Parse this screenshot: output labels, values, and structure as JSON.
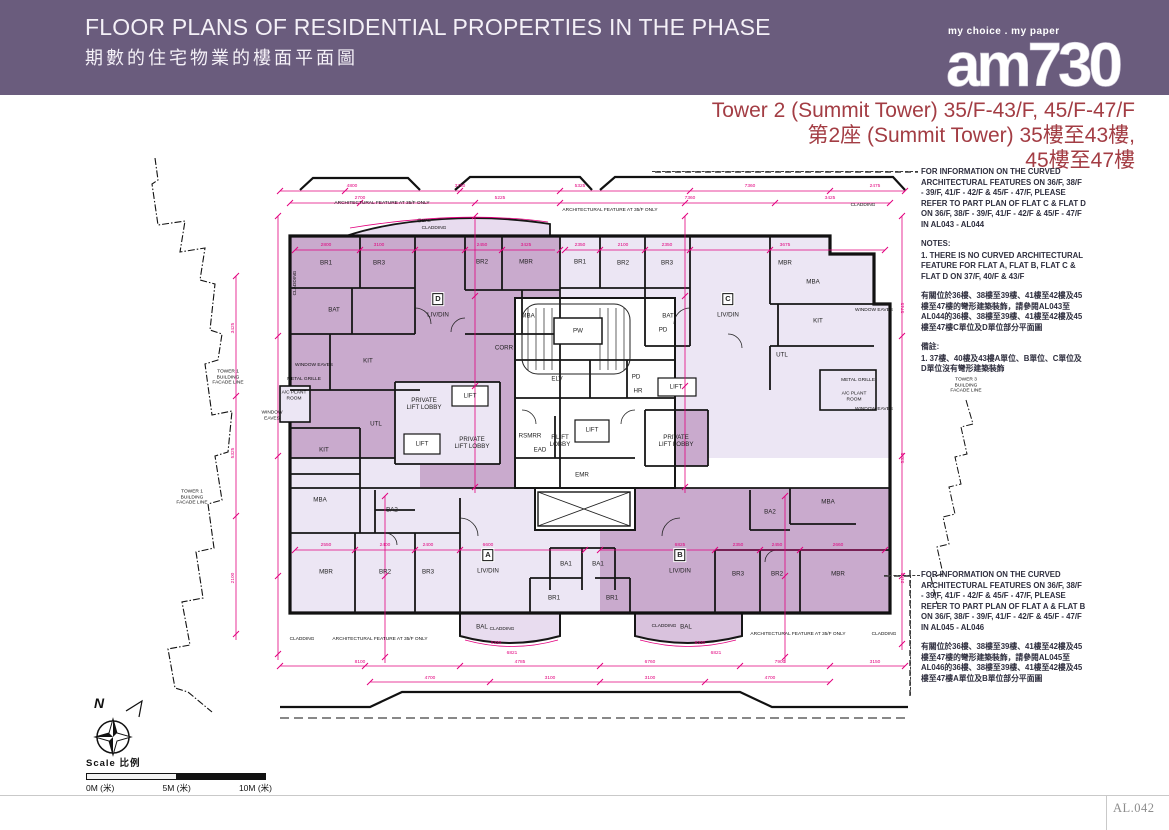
{
  "header": {
    "title_en": "FLOOR PLANS OF RESIDENTIAL PROPERTIES IN THE PHASE",
    "title_zh": "期數的住宅物業的樓面平面圖",
    "logo_tagline": "my choice . my paper",
    "logo_text": "am730"
  },
  "tower_title": {
    "line1": "Tower 2 (Summit Tower) 35/F-43/F, 45/F-47/F",
    "line2": "第2座 (Summit Tower) 35樓至43樓,",
    "line3": "45樓至47樓"
  },
  "notes_top": {
    "en": "FOR INFORMATION ON THE CURVED\nARCHITECTURAL FEATURES ON 36/F, 38/F\n- 39/F, 41/F - 42/F & 45/F - 47/F, PLEASE\nREFER TO PART PLAN OF FLAT C & FLAT D\nON 36/F, 38/F - 39/F, 41/F - 42/F & 45/F - 47/F\nIN AL043 - AL044",
    "notes_heading": "NOTES:",
    "note1": "1.  THERE IS NO CURVED ARCHITECTURAL\nFEATURE FOR FLAT A, FLAT B, FLAT C &\nFLAT D ON 37/F, 40/F & 43/F",
    "zh": "有關位於36樓、38樓至39樓、41樓至42樓及45\n樓至47樓的彎形建築裝飾，請參閱AL043至\nAL044的36樓、38樓至39樓、41樓至42樓及45\n樓至47樓C單位及D單位部分平面圖",
    "zh_heading": "備註:",
    "zh_note1": "1.  37樓、40樓及43樓A單位、B單位、C單位及\nD單位沒有彎形建築裝飾"
  },
  "notes_bottom": {
    "en": "FOR INFORMATION ON THE CURVED\nARCHITECTURAL FEATURES ON 36/F, 38/F\n- 39/F, 41/F - 42/F & 45/F - 47/F, PLEASE\nREFER TO PART PLAN OF FLAT A & FLAT B\nON 36/F, 38/F - 39/F, 41/F - 42/F & 45/F - 47/F\nIN AL045 - AL046",
    "zh": "有關位於36樓、38樓至39樓、41樓至42樓及45\n樓至47樓的彎形建築裝飾，請參閱AL045至\nAL046的36樓、38樓至39樓、41樓至42樓及45\n樓至47樓A單位及B單位部分平面圖"
  },
  "scale": {
    "label": "Scale  比例",
    "m0": "0M (米)",
    "m5": "5M (米)",
    "m10": "10M (米)"
  },
  "compass": {
    "north": "N"
  },
  "page_number": "AL.042",
  "colors": {
    "band_purple": "#6a5c7d",
    "title_red": "#a33d44",
    "dimension_magenta": "#e2007e",
    "unit_mauve": "#c9aacd",
    "unit_light": "#ece6f4"
  },
  "plan": {
    "labels": [
      {
        "t": "BR1",
        "x": 196,
        "y": 105
      },
      {
        "t": "BR3",
        "x": 249,
        "y": 105
      },
      {
        "t": "BR2",
        "x": 352,
        "y": 104
      },
      {
        "t": "MBR",
        "x": 396,
        "y": 104
      },
      {
        "t": "BAT",
        "x": 204,
        "y": 152
      },
      {
        "t": "MBA",
        "x": 398,
        "y": 158
      },
      {
        "t": "D",
        "x": 308,
        "y": 141,
        "c": "un"
      },
      {
        "t": "LIV/DIN",
        "x": 308,
        "y": 157
      },
      {
        "t": "KIT",
        "x": 238,
        "y": 203
      },
      {
        "t": "CORR",
        "x": 374,
        "y": 190
      },
      {
        "t": "PRIVATE\nLIFT LOBBY",
        "x": 294,
        "y": 246
      },
      {
        "t": "LIFT",
        "x": 340,
        "y": 238
      },
      {
        "t": "UTL",
        "x": 246,
        "y": 266
      },
      {
        "t": "LIFT",
        "x": 292,
        "y": 286
      },
      {
        "t": "PRIVATE\nLIFT LOBBY",
        "x": 342,
        "y": 285
      },
      {
        "t": "BR1",
        "x": 450,
        "y": 104
      },
      {
        "t": "BR2",
        "x": 493,
        "y": 105
      },
      {
        "t": "BR3",
        "x": 537,
        "y": 105
      },
      {
        "t": "MBR",
        "x": 655,
        "y": 105
      },
      {
        "t": "MBA",
        "x": 683,
        "y": 124
      },
      {
        "t": "BAT",
        "x": 538,
        "y": 158
      },
      {
        "t": "C",
        "x": 598,
        "y": 141,
        "c": "un"
      },
      {
        "t": "LIV/DIN",
        "x": 598,
        "y": 157
      },
      {
        "t": "KIT",
        "x": 688,
        "y": 163
      },
      {
        "t": "UTL",
        "x": 652,
        "y": 197
      },
      {
        "t": "LIFT",
        "x": 546,
        "y": 229
      },
      {
        "t": "PRIVATE\nLIFT LOBBY",
        "x": 546,
        "y": 283
      },
      {
        "t": "PW",
        "x": 448,
        "y": 173
      },
      {
        "t": "ELV",
        "x": 427,
        "y": 221
      },
      {
        "t": "PD",
        "x": 506,
        "y": 219
      },
      {
        "t": "HR",
        "x": 508,
        "y": 233
      },
      {
        "t": "PD",
        "x": 533,
        "y": 172
      },
      {
        "t": "F.LIFT\nLOBBY",
        "x": 430,
        "y": 283
      },
      {
        "t": "LIFT",
        "x": 462,
        "y": 272
      },
      {
        "t": "RSMRR",
        "x": 400,
        "y": 278
      },
      {
        "t": "EAD",
        "x": 410,
        "y": 292
      },
      {
        "t": "EMR",
        "x": 452,
        "y": 317
      },
      {
        "t": "KIT",
        "x": 194,
        "y": 292
      },
      {
        "t": "MBA",
        "x": 190,
        "y": 342
      },
      {
        "t": "BA2",
        "x": 262,
        "y": 352
      },
      {
        "t": "MBR",
        "x": 196,
        "y": 414
      },
      {
        "t": "BR2",
        "x": 255,
        "y": 414
      },
      {
        "t": "BR3",
        "x": 298,
        "y": 414
      },
      {
        "t": "A",
        "x": 358,
        "y": 397,
        "c": "un"
      },
      {
        "t": "LIV/DIN",
        "x": 358,
        "y": 413
      },
      {
        "t": "BA1",
        "x": 436,
        "y": 406
      },
      {
        "t": "BA1",
        "x": 468,
        "y": 406
      },
      {
        "t": "BR1",
        "x": 424,
        "y": 440
      },
      {
        "t": "BAL",
        "x": 352,
        "y": 469
      },
      {
        "t": "B",
        "x": 550,
        "y": 397,
        "c": "un"
      },
      {
        "t": "LIV/DIN",
        "x": 550,
        "y": 413
      },
      {
        "t": "BR1",
        "x": 482,
        "y": 440
      },
      {
        "t": "BR3",
        "x": 608,
        "y": 416
      },
      {
        "t": "BR2",
        "x": 647,
        "y": 416
      },
      {
        "t": "MBR",
        "x": 708,
        "y": 416
      },
      {
        "t": "MBA",
        "x": 698,
        "y": 344
      },
      {
        "t": "BA2",
        "x": 640,
        "y": 354
      },
      {
        "t": "BAL",
        "x": 556,
        "y": 469
      },
      {
        "t": "ARCHITECTURAL FEATURE AT 35/F ONLY",
        "x": 252,
        "y": 46,
        "c": "an"
      },
      {
        "t": "ARCHITECTURAL FEATURE AT 35/F ONLY",
        "x": 480,
        "y": 53,
        "c": "an"
      },
      {
        "t": "@BAL",
        "x": 294,
        "y": 64,
        "c": "an"
      },
      {
        "t": "CLADDING",
        "x": 304,
        "y": 71,
        "c": "an"
      },
      {
        "t": "CLADDING",
        "x": 733,
        "y": 48,
        "c": "an"
      },
      {
        "t": "CLADDING",
        "x": 166,
        "y": 125,
        "c": "an",
        "r": -90
      },
      {
        "t": "WINDOW EAVES",
        "x": 184,
        "y": 208,
        "c": "an"
      },
      {
        "t": "METAL GRILLE",
        "x": 174,
        "y": 222,
        "c": "an"
      },
      {
        "t": "A/C PLANT\nROOM",
        "x": 164,
        "y": 238,
        "c": "an"
      },
      {
        "t": "WINDOW\nEAVES",
        "x": 142,
        "y": 258,
        "c": "an"
      },
      {
        "t": "WINDOW EAVES",
        "x": 744,
        "y": 153,
        "c": "an"
      },
      {
        "t": "METAL GRILLE",
        "x": 728,
        "y": 223,
        "c": "an"
      },
      {
        "t": "A/C PLANT\nROOM",
        "x": 724,
        "y": 239,
        "c": "an"
      },
      {
        "t": "WINDOW EAVES",
        "x": 744,
        "y": 252,
        "c": "an"
      },
      {
        "t": "TOWER 1\nBUILDING\nFACADE LINE",
        "x": 98,
        "y": 220,
        "c": "an"
      },
      {
        "t": "TOWER 1\nBUILDING\nFACADE LINE",
        "x": 62,
        "y": 340,
        "c": "an"
      },
      {
        "t": "TOWER 3\nBUILDING\nFACADE LINE",
        "x": 836,
        "y": 228,
        "c": "an"
      },
      {
        "t": "CLADDING",
        "x": 172,
        "y": 482,
        "c": "an"
      },
      {
        "t": "ARCHITECTURAL FEATURE AT 35/F ONLY",
        "x": 250,
        "y": 482,
        "c": "an"
      },
      {
        "t": "CLADDING",
        "x": 372,
        "y": 472,
        "c": "an"
      },
      {
        "t": "CLADDING",
        "x": 534,
        "y": 469,
        "c": "an"
      },
      {
        "t": "ARCHITECTURAL FEATURE AT 35/F ONLY",
        "x": 668,
        "y": 477,
        "c": "an"
      },
      {
        "t": "CLADDING",
        "x": 754,
        "y": 477,
        "c": "an"
      },
      {
        "t": "4800",
        "x": 222,
        "y": 29,
        "c": "dim"
      },
      {
        "t": "3750",
        "x": 330,
        "y": 29,
        "c": "dim"
      },
      {
        "t": "5325",
        "x": 450,
        "y": 29,
        "c": "dim"
      },
      {
        "t": "7360",
        "x": 620,
        "y": 29,
        "c": "dim"
      },
      {
        "t": "2475",
        "x": 745,
        "y": 29,
        "c": "dim"
      },
      {
        "t": "2700",
        "x": 230,
        "y": 41,
        "c": "dim"
      },
      {
        "t": "5225",
        "x": 370,
        "y": 41,
        "c": "dim"
      },
      {
        "t": "7360",
        "x": 560,
        "y": 41,
        "c": "dim"
      },
      {
        "t": "3425",
        "x": 700,
        "y": 41,
        "c": "dim"
      },
      {
        "t": "2800",
        "x": 196,
        "y": 88,
        "c": "dim"
      },
      {
        "t": "3100",
        "x": 249,
        "y": 88,
        "c": "dim"
      },
      {
        "t": "2450",
        "x": 352,
        "y": 88,
        "c": "dim"
      },
      {
        "t": "3425",
        "x": 396,
        "y": 88,
        "c": "dim"
      },
      {
        "t": "2350",
        "x": 450,
        "y": 88,
        "c": "dim"
      },
      {
        "t": "2100",
        "x": 493,
        "y": 88,
        "c": "dim"
      },
      {
        "t": "2350",
        "x": 537,
        "y": 88,
        "c": "dim"
      },
      {
        "t": "3675",
        "x": 655,
        "y": 88,
        "c": "dim"
      },
      {
        "t": "2550",
        "x": 196,
        "y": 388,
        "c": "dim"
      },
      {
        "t": "2400",
        "x": 255,
        "y": 388,
        "c": "dim"
      },
      {
        "t": "2400",
        "x": 298,
        "y": 388,
        "c": "dim"
      },
      {
        "t": "6600",
        "x": 358,
        "y": 388,
        "c": "dim"
      },
      {
        "t": "6825",
        "x": 550,
        "y": 388,
        "c": "dim"
      },
      {
        "t": "2350",
        "x": 608,
        "y": 388,
        "c": "dim"
      },
      {
        "t": "2450",
        "x": 647,
        "y": 388,
        "c": "dim"
      },
      {
        "t": "2660",
        "x": 708,
        "y": 388,
        "c": "dim"
      },
      {
        "t": "8100",
        "x": 230,
        "y": 505,
        "c": "dim"
      },
      {
        "t": "4785",
        "x": 390,
        "y": 505,
        "c": "dim"
      },
      {
        "t": "6760",
        "x": 520,
        "y": 505,
        "c": "dim"
      },
      {
        "t": "7900",
        "x": 650,
        "y": 505,
        "c": "dim"
      },
      {
        "t": "3150",
        "x": 745,
        "y": 505,
        "c": "dim"
      },
      {
        "t": "4700",
        "x": 300,
        "y": 521,
        "c": "dim"
      },
      {
        "t": "3100",
        "x": 420,
        "y": 521,
        "c": "dim"
      },
      {
        "t": "3100",
        "x": 520,
        "y": 521,
        "c": "dim"
      },
      {
        "t": "4700",
        "x": 640,
        "y": 521,
        "c": "dim"
      },
      {
        "t": "3425",
        "x": 104,
        "y": 170,
        "c": "dim",
        "r": -90
      },
      {
        "t": "5325",
        "x": 104,
        "y": 295,
        "c": "dim",
        "r": -90
      },
      {
        "t": "2100",
        "x": 104,
        "y": 420,
        "c": "dim",
        "r": -90
      },
      {
        "t": "5745",
        "x": 774,
        "y": 150,
        "c": "dim",
        "r": -90
      },
      {
        "t": "5325",
        "x": 774,
        "y": 300,
        "c": "dim",
        "r": -90
      },
      {
        "t": "2105",
        "x": 774,
        "y": 420,
        "c": "dim",
        "r": -90
      },
      {
        "t": "6320",
        "x": 366,
        "y": 486,
        "c": "dim"
      },
      {
        "t": "6821",
        "x": 382,
        "y": 496,
        "c": "dim"
      },
      {
        "t": "6320",
        "x": 570,
        "y": 486,
        "c": "dim"
      },
      {
        "t": "6821",
        "x": 586,
        "y": 496,
        "c": "dim"
      }
    ]
  }
}
